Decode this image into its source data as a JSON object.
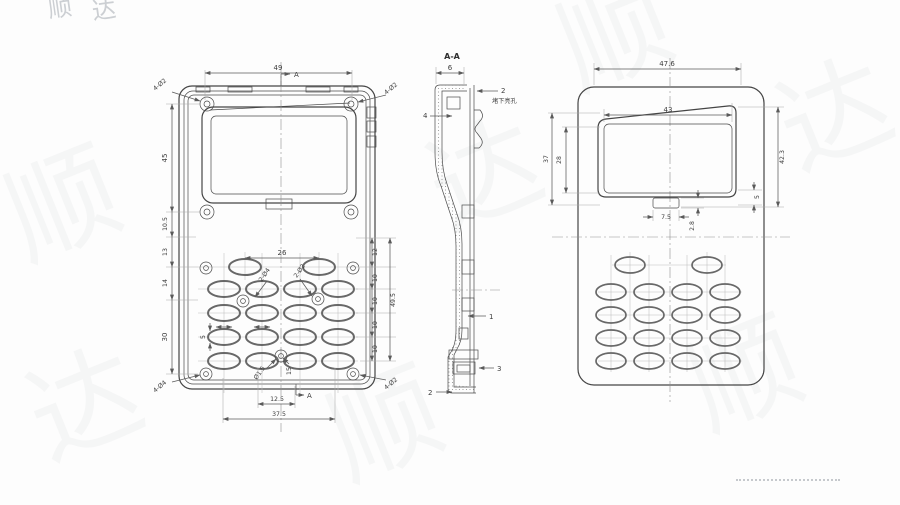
{
  "watermark": {
    "char_a": "顺",
    "char_b": "达"
  },
  "front": {
    "dim_top_width": "49",
    "section_marker": "A",
    "left_dims": {
      "screen_h": "45",
      "gap": "10.5",
      "d13": "13",
      "d14": "14",
      "d30": "30"
    },
    "right_dims": {
      "d12": "12",
      "d10a": "10",
      "d10b": "10",
      "d10c": "10",
      "d10d": "10",
      "total": "49.5"
    },
    "bottom_dims": {
      "inner": "12.5",
      "outer": "37.5"
    },
    "keypad_dims": {
      "pitch": "26",
      "small5": "5",
      "hole_pair_a": "2-Ø4",
      "hole_pair_b": "2-Ø2",
      "hole_c": "Ø1.5",
      "hole_d": "15"
    },
    "corner_labels": {
      "tl": "4-Ø2",
      "tr": "4-Ø2",
      "bl": "4-Ø4",
      "br": "4-Ø2"
    }
  },
  "section": {
    "title": "A-A",
    "dim_top": "6",
    "callout_wall": "2",
    "callout_note": "堵下亮孔",
    "callout_left": "4",
    "callout_rib": "1",
    "callout_boss": "3",
    "callout_bottom": "2"
  },
  "back": {
    "dim_top_width": "47.6",
    "dim_window_width": "43",
    "dim_right_height": "42.3",
    "dim_left_outer": "37",
    "dim_left_inner": "28",
    "dim_tab_width": "7.5",
    "dim_tab_height": "2.8",
    "dim_small": "5"
  }
}
